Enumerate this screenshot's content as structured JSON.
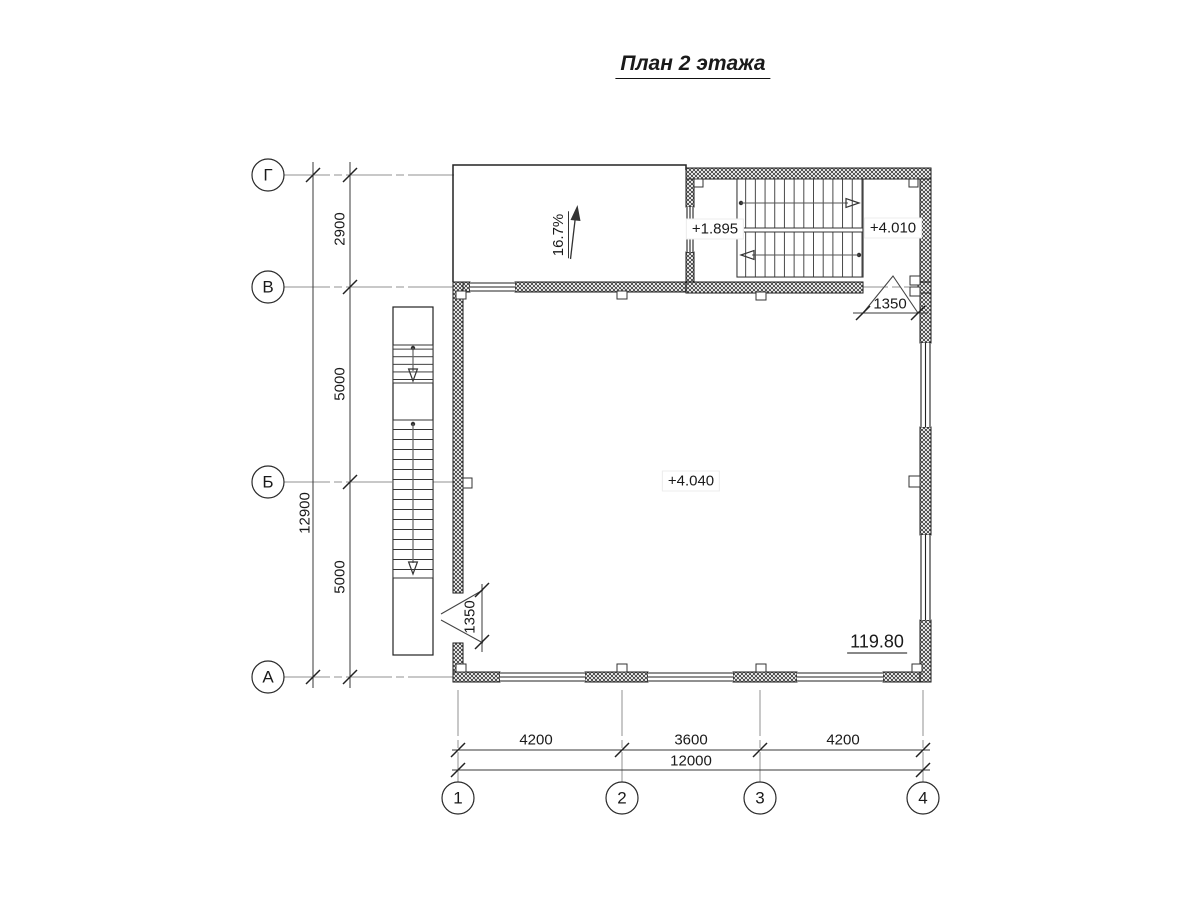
{
  "title": "План 2 этажа",
  "axes": {
    "rows": [
      {
        "label": "Г"
      },
      {
        "label": "В"
      },
      {
        "label": "Б"
      },
      {
        "label": "А"
      }
    ],
    "cols": [
      {
        "label": "1"
      },
      {
        "label": "2"
      },
      {
        "label": "3"
      },
      {
        "label": "4"
      }
    ]
  },
  "dimensions": {
    "left_spans": [
      {
        "value": "2900"
      },
      {
        "value": "5000"
      },
      {
        "value": "5000"
      }
    ],
    "left_total": "12900",
    "bottom_spans": [
      {
        "value": "4200"
      },
      {
        "value": "3600"
      },
      {
        "value": "4200"
      }
    ],
    "bottom_total": "12000",
    "west_door_width": "1350",
    "north_door_width": "1350"
  },
  "levels": {
    "stair_mid_landing": "+1.895",
    "stair_top_landing": "+4.010",
    "floor": "+4.040"
  },
  "ramp": {
    "slope": "16.7%"
  },
  "area": {
    "value": "119.80"
  }
}
